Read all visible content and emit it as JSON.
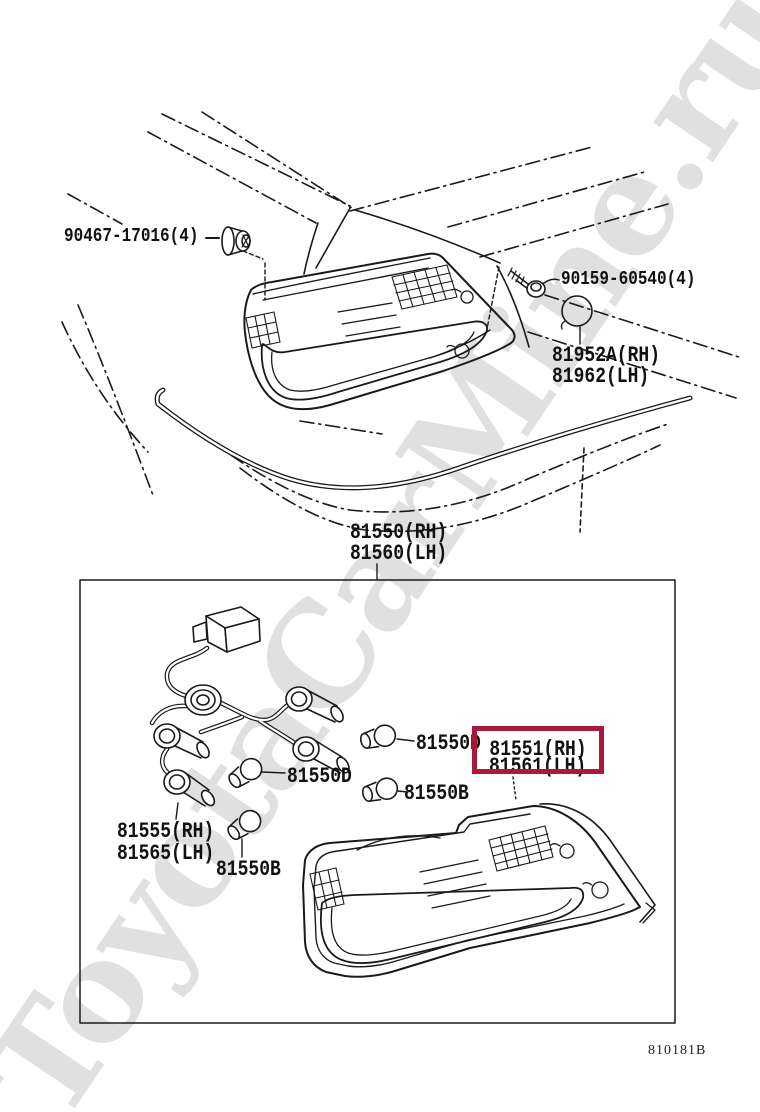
{
  "watermark": {
    "text": "ToyotaCarMine.ru",
    "color": "#e0e0e0"
  },
  "diagram_code": "810181B",
  "colors": {
    "highlight_box": "#a8193c",
    "line": "#1a1a1a",
    "background": "#ffffff"
  },
  "parts": {
    "clip": {
      "label": "90467-17016(4)"
    },
    "screw": {
      "label": "90159-60540(4)"
    },
    "grommet_rh": {
      "label": "81952A(RH)"
    },
    "grommet_lh": {
      "label": "81962(LH)"
    },
    "assembly_rh": {
      "label": "81550(RH)"
    },
    "assembly_lh": {
      "label": "81560(LH)"
    },
    "bulb_d_1": {
      "label": "81550D"
    },
    "lens_rh": {
      "label": "81551(RH)",
      "highlighted": true
    },
    "lens_lh": {
      "label": "81561(LH)"
    },
    "bulb_d_2": {
      "label": "81550D"
    },
    "bulb_b_1": {
      "label": "81550B"
    },
    "socket_rh": {
      "label": "81555(RH)"
    },
    "socket_lh": {
      "label": "81565(LH)"
    },
    "bulb_b_2": {
      "label": "81550B"
    }
  }
}
